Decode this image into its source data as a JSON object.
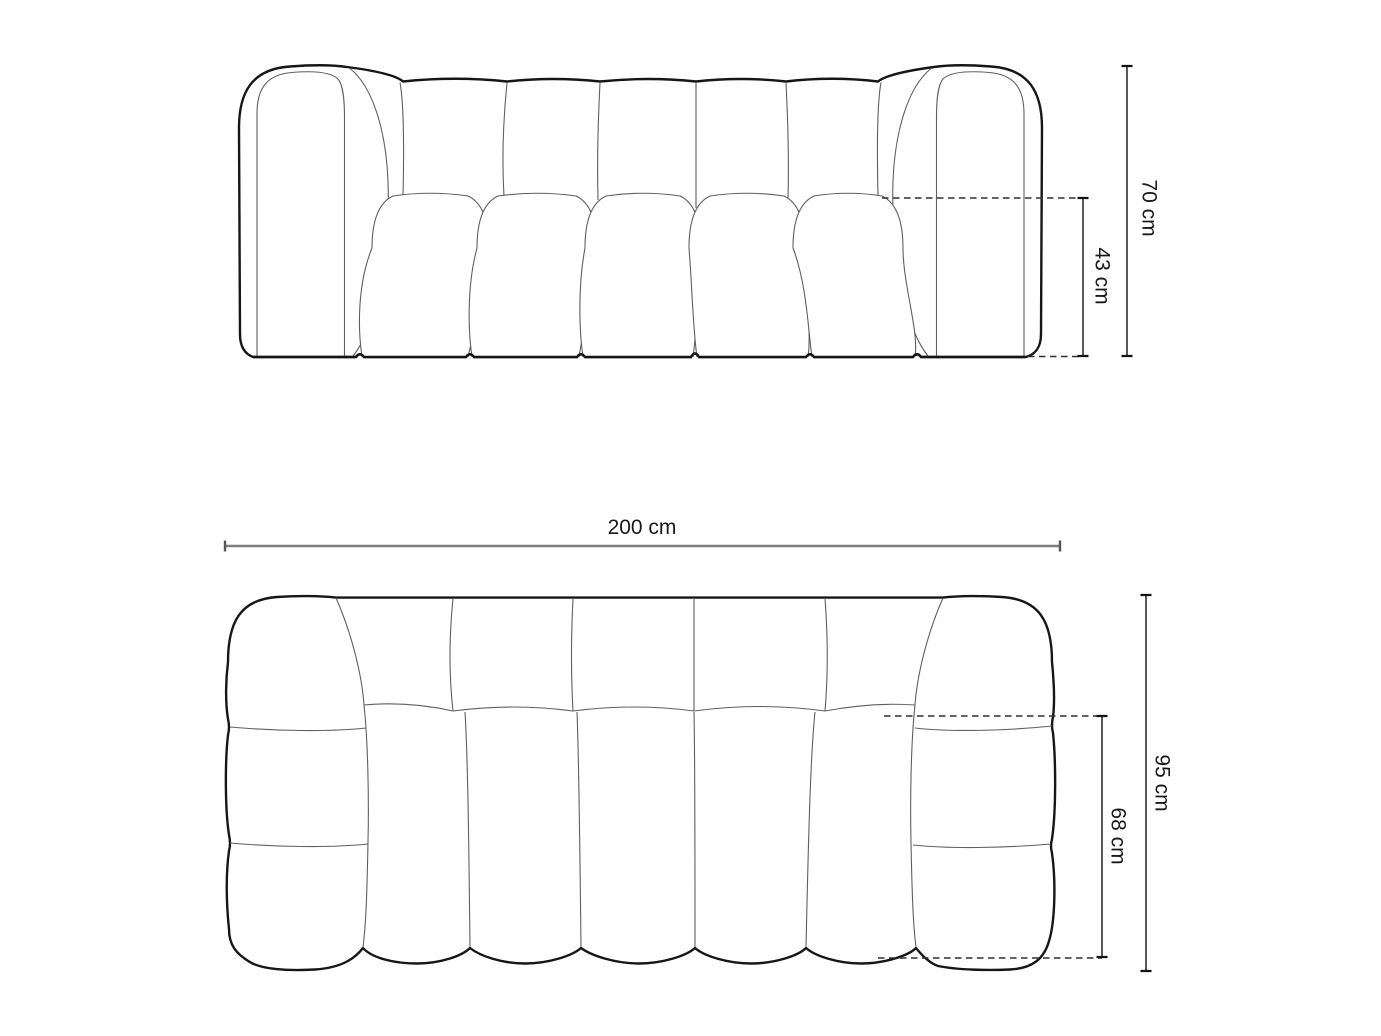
{
  "diagram": {
    "front_view": {
      "overall_height_label": "70 cm",
      "seat_height_label": "43 cm"
    },
    "top_view": {
      "overall_width_label": "200 cm",
      "overall_depth_label": "95 cm",
      "seat_depth_label": "68 cm"
    },
    "colors": {
      "background": "#ffffff",
      "outline": "#161616",
      "seam_line": "#5f5f5f",
      "dimension_line": "#111111",
      "width_dimension_line": "#7d7d7d",
      "dashed_reference_line": "#2e2e2e",
      "text": "#1a1a1a"
    }
  }
}
